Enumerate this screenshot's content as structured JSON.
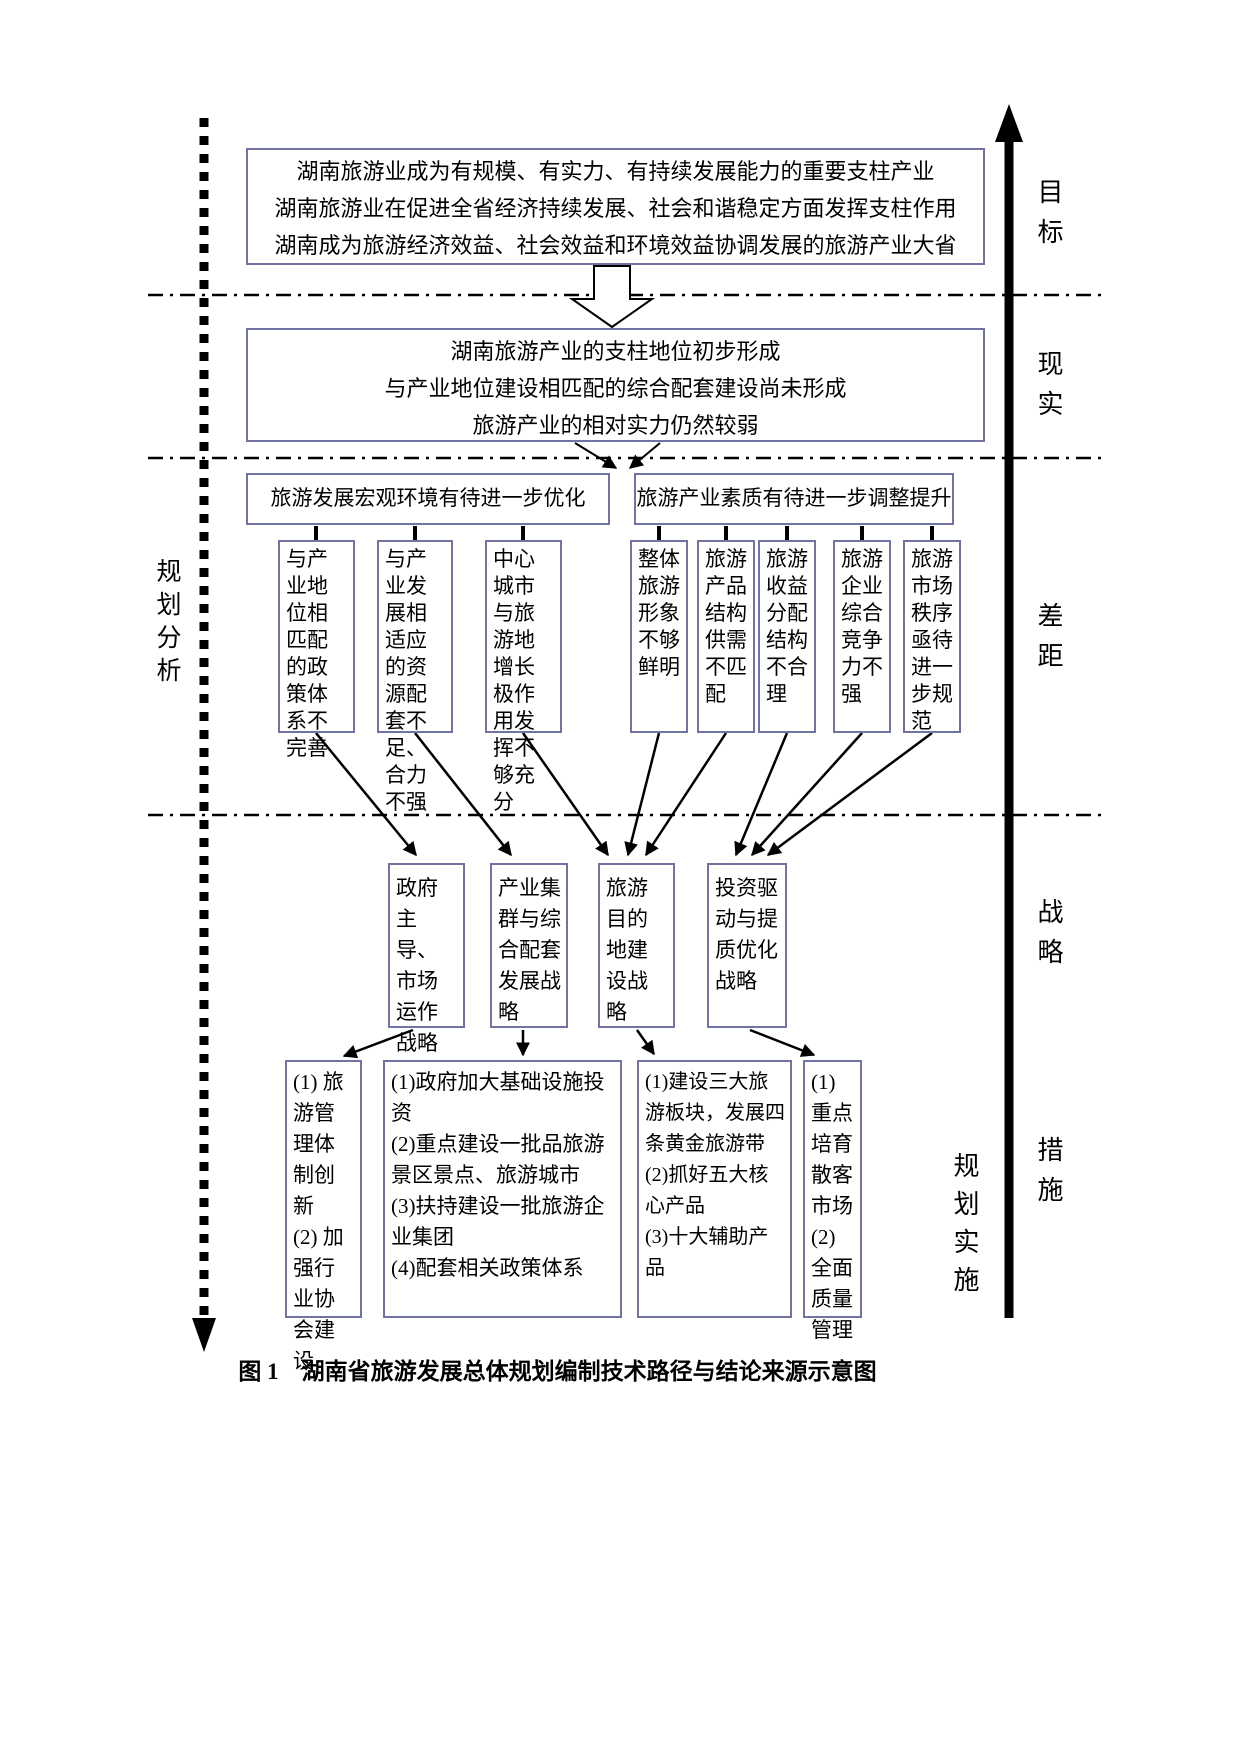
{
  "figure": {
    "caption": "图 1　湖南省旅游发展总体规划编制技术路径与结论来源示意图"
  },
  "axis_labels": {
    "left_process": "规划分析",
    "right_process": "规划实施",
    "sections": [
      "目标",
      "现实",
      "差距",
      "战略",
      "措施"
    ]
  },
  "goal_box": {
    "lines": [
      "湖南旅游业成为有规模、有实力、有持续发展能力的重要支柱产业",
      "湖南旅游业在促进全省经济持续发展、社会和谐稳定方面发挥支柱作用",
      "湖南成为旅游经济效益、社会效益和环境效益协调发展的旅游产业大省"
    ]
  },
  "reality_box": {
    "lines": [
      "湖南旅游产业的支柱地位初步形成",
      "与产业地位建设相匹配的综合配套建设尚未形成",
      "旅游产业的相对实力仍然较弱"
    ]
  },
  "gap": {
    "headers": [
      "旅游发展宏观环境有待进一步优化",
      "旅游产业素质有待进一步调整提升"
    ],
    "items": [
      "与产业地位相匹配的政策体系不完善",
      "与产业发展相适应的资源配套不足、合力不强",
      "中心城市与旅游地增长极作用发挥不够充分",
      "整体旅游形象不够鲜明",
      "旅游产品结构供需不匹配",
      "旅游收益分配结构不合理",
      "旅游企业综合竞争力不强",
      "旅游市场秩序亟待进一步规范"
    ]
  },
  "strategies": [
    "政府主导、市场运作战略",
    "产业集群与综合配套发展战略",
    "旅游目的地建设战略",
    "投资驱动与提质优化战略"
  ],
  "measures": [
    {
      "items": [
        "(1) 旅游管理体制创新",
        "(2) 加强行业协会建设"
      ]
    },
    {
      "items": [
        "(1)政府加大基础设施投资",
        "(2)重点建设一批品旅游景区景点、旅游城市",
        "(3)扶持建设一批旅游企业集团",
        "(4)配套相关政策体系"
      ]
    },
    {
      "items": [
        "(1)建设三大旅游板块，发展四条黄金旅游带",
        "(2)抓好五大核心产品",
        "(3)十大辅助产品"
      ]
    },
    {
      "items": [
        "(1)重点培育散客市场(2)全面质量管理"
      ]
    }
  ],
  "colors": {
    "box_border": "#7273a5",
    "line": "#000000"
  }
}
